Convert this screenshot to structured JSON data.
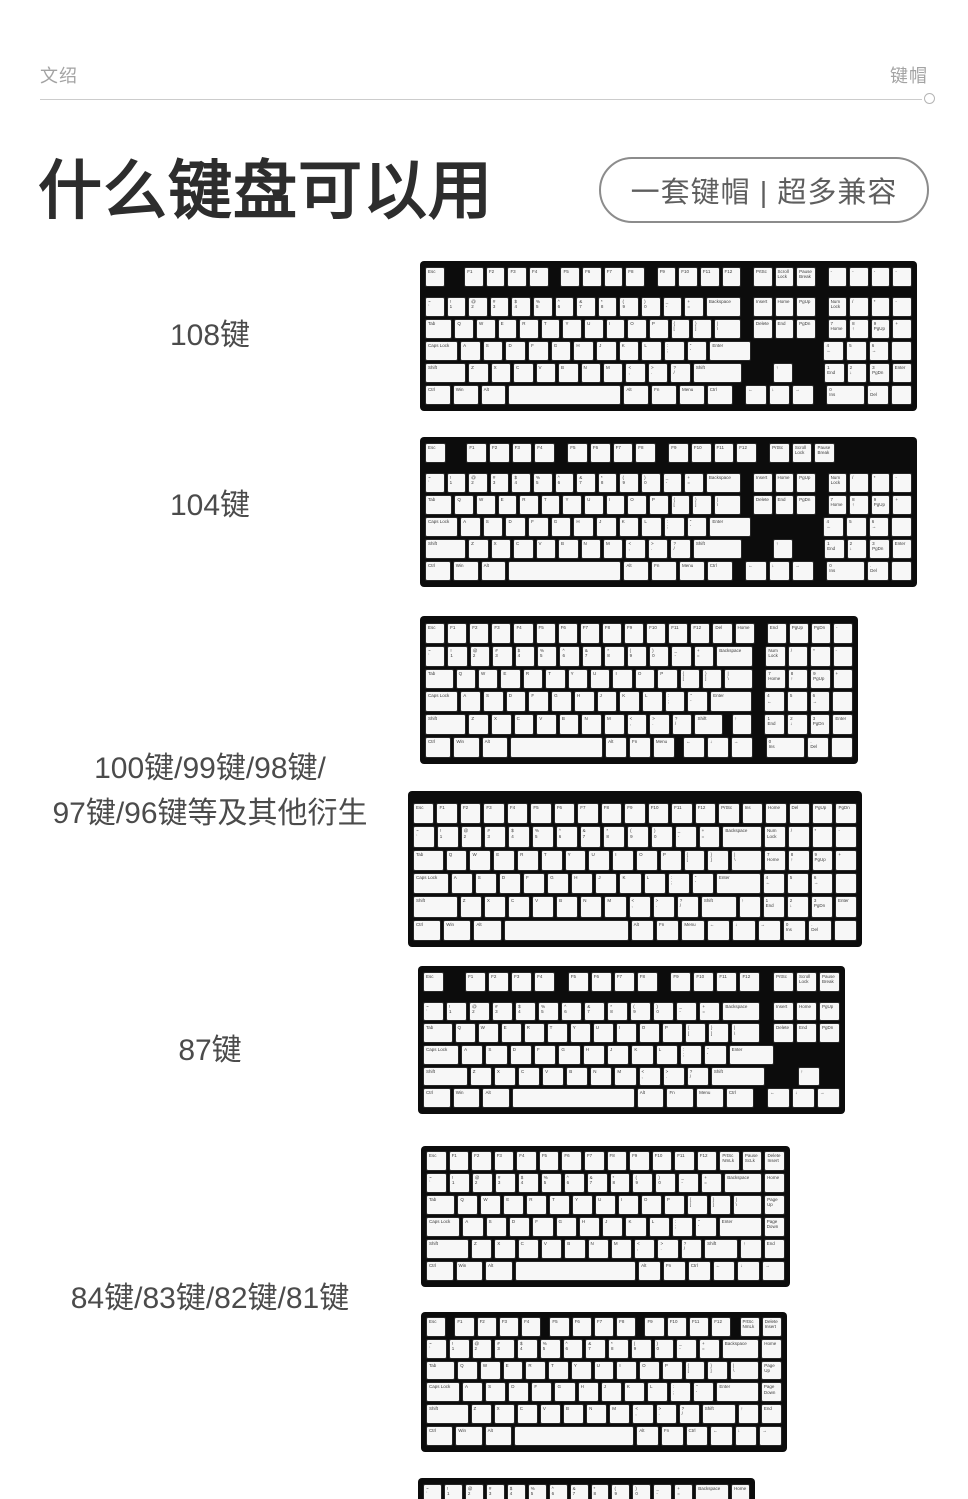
{
  "header": {
    "left": "文绍",
    "right": "键帽"
  },
  "title": {
    "text": "什么键盘可以用"
  },
  "badge": {
    "text": "一套键帽  |  超多兼容"
  },
  "colors": {
    "title": "#2d2d2d",
    "row_label": "#4b4b4b",
    "header_text": "#a3a3a3",
    "badge_border": "#8c8c8c",
    "badge_text": "#5e5e5e",
    "rule": "#cccccc",
    "keyboard_bezel": "#0c0c0c",
    "keycap_bg": "#f7f7f7",
    "keycap_border": "#262626",
    "keycap_text": "#3c3c3c"
  },
  "sections": [
    {
      "label_lines": [
        "108键"
      ],
      "label_top": 313
    },
    {
      "label_lines": [
        "104键"
      ],
      "label_top": 483
    },
    {
      "label_lines": [
        "100键/99键/98键/",
        "97键/96键等及其他衍生"
      ],
      "label_top": 746
    },
    {
      "label_lines": [
        "87键"
      ],
      "label_top": 1028
    },
    {
      "label_lines": [
        "84键/83键/82键/81键"
      ],
      "label_top": 1276
    }
  ],
  "lib": {
    "f_gapped": [
      [
        "Esc",
        1
      ],
      [
        "",
        1,
        "g"
      ],
      [
        "F1",
        1
      ],
      [
        "F2",
        1
      ],
      [
        "F3",
        1
      ],
      [
        "F4",
        1
      ],
      [
        "",
        0.5,
        "g"
      ],
      [
        "F5",
        1
      ],
      [
        "F6",
        1
      ],
      [
        "F7",
        1
      ],
      [
        "F8",
        1
      ],
      [
        "",
        0.5,
        "g"
      ],
      [
        "F9",
        1
      ],
      [
        "F10",
        1
      ],
      [
        "F11",
        1
      ],
      [
        "F12",
        1
      ]
    ],
    "fkeys12": [
      [
        "F1",
        1
      ],
      [
        "F2",
        1
      ],
      [
        "F3",
        1
      ],
      [
        "F4",
        1
      ],
      [
        "F5",
        1
      ],
      [
        "F6",
        1
      ],
      [
        "F7",
        1
      ],
      [
        "F8",
        1
      ],
      [
        "F9",
        1
      ],
      [
        "F10",
        1
      ],
      [
        "F11",
        1
      ],
      [
        "F12",
        1
      ]
    ],
    "prt": [
      [
        "",
        0.5,
        "g"
      ],
      [
        "PrtSc",
        1
      ],
      [
        "Scroll\nLock",
        1
      ],
      [
        "Pause\nBreak",
        1
      ]
    ],
    "extra4": [
      [
        "",
        0.5,
        "g"
      ],
      [
        "-",
        1
      ],
      [
        "-",
        1
      ],
      [
        "-",
        1
      ],
      [
        "-",
        1
      ]
    ],
    "extra4_blank": [
      [
        "",
        4.5,
        "g"
      ]
    ],
    "numrow": [
      [
        "~\n`",
        1
      ],
      [
        "!\n1",
        1
      ],
      [
        "@\n2",
        1
      ],
      [
        "#\n3",
        1
      ],
      [
        "$\n4",
        1
      ],
      [
        "%\n5",
        1
      ],
      [
        "^\n6",
        1
      ],
      [
        "&\n7",
        1
      ],
      [
        "*\n8",
        1
      ],
      [
        "(\n9",
        1
      ],
      [
        ")\n0",
        1
      ],
      [
        "_\n-",
        1
      ],
      [
        "+\n=",
        1
      ],
      [
        "Backspace",
        2
      ]
    ],
    "tabrow": [
      [
        "Tab",
        1.5
      ],
      [
        "Q",
        1
      ],
      [
        "W",
        1
      ],
      [
        "E",
        1
      ],
      [
        "R",
        1
      ],
      [
        "T",
        1
      ],
      [
        "Y",
        1
      ],
      [
        "U",
        1
      ],
      [
        "I",
        1
      ],
      [
        "O",
        1
      ],
      [
        "P",
        1
      ],
      [
        "{\n[",
        1
      ],
      [
        "}\n]",
        1
      ],
      [
        "|\n\\",
        1.5
      ]
    ],
    "capsrow": [
      [
        "Caps Lock",
        1.75
      ],
      [
        "A",
        1
      ],
      [
        "S",
        1
      ],
      [
        "D",
        1
      ],
      [
        "F",
        1
      ],
      [
        "G",
        1
      ],
      [
        "H",
        1
      ],
      [
        "J",
        1
      ],
      [
        "K",
        1
      ],
      [
        "L",
        1
      ],
      [
        ":\n;",
        1
      ],
      [
        "\"\n'",
        1
      ],
      [
        "Enter",
        2.25
      ]
    ],
    "zkeys": [
      [
        "Z",
        1
      ],
      [
        "X",
        1
      ],
      [
        "C",
        1
      ],
      [
        "V",
        1
      ],
      [
        "B",
        1
      ],
      [
        "N",
        1
      ],
      [
        "M",
        1
      ],
      [
        "<\n,",
        1
      ],
      [
        ">\n.",
        1
      ],
      [
        "?\n/",
        1
      ]
    ],
    "shiftrow": [
      [
        "Shift",
        2.25
      ],
      "zkeys",
      [
        "Shift",
        2.75
      ]
    ],
    "bottomrow": [
      [
        "Ctrl",
        1.25
      ],
      [
        "Win",
        1.25
      ],
      [
        "Alt",
        1.25
      ],
      [
        "",
        6.25
      ],
      [
        "Alt",
        1.25
      ],
      [
        "Fn",
        1.25
      ],
      [
        "Menu",
        1.25
      ],
      [
        "Ctrl",
        1.25
      ]
    ],
    "nav1": [
      [
        "",
        0.5,
        "g"
      ],
      [
        "Insert",
        1
      ],
      [
        "Home",
        1
      ],
      [
        "PgUp",
        1
      ]
    ],
    "nav2": [
      [
        "",
        0.5,
        "g"
      ],
      [
        "Delete",
        1
      ],
      [
        "End",
        1
      ],
      [
        "PgDn",
        1
      ]
    ],
    "nav3": [
      [
        "",
        3.5,
        "g"
      ]
    ],
    "nav_up": [
      [
        "",
        0.5,
        "g"
      ],
      [
        "",
        1,
        "g"
      ],
      [
        "↑",
        1
      ],
      [
        "",
        1,
        "g"
      ]
    ],
    "nav_arr": [
      [
        "",
        0.5,
        "g"
      ],
      [
        "←",
        1
      ],
      [
        "↓",
        1
      ],
      [
        "→",
        1
      ]
    ],
    "np1": [
      [
        "",
        0.5,
        "g"
      ],
      [
        "Num\nLock",
        1
      ],
      [
        "/",
        1
      ],
      [
        "*",
        1
      ],
      [
        "-",
        1
      ]
    ],
    "np2": [
      [
        "",
        0.5,
        "g"
      ],
      [
        "7\nHome",
        1
      ],
      [
        "8\n↑",
        1
      ],
      [
        "9\nPgUp",
        1
      ],
      [
        "+",
        1
      ]
    ],
    "np3": [
      [
        "",
        0.5,
        "g"
      ],
      [
        "4\n←",
        1
      ],
      [
        "5",
        1
      ],
      [
        "6\n→",
        1
      ],
      [
        "",
        1
      ]
    ],
    "np4": [
      [
        "",
        0.5,
        "g"
      ],
      [
        "1\nEnd",
        1
      ],
      [
        "2\n↓",
        1
      ],
      [
        "3\nPgDn",
        1
      ],
      [
        "Enter",
        1
      ]
    ],
    "np5": [
      [
        "",
        0.5,
        "g"
      ],
      [
        "0\nIns",
        2
      ],
      [
        ".\nDel",
        1
      ],
      [
        "",
        1
      ]
    ],
    "np1n": [
      [
        "Num\nLock",
        1
      ],
      [
        "/",
        1
      ],
      [
        "*",
        1
      ],
      [
        "-",
        1
      ]
    ],
    "np2n": [
      [
        "7\nHome",
        1
      ],
      [
        "8\n↑",
        1
      ],
      [
        "9\nPgUp",
        1
      ],
      [
        "+",
        1
      ]
    ],
    "np3n": [
      [
        "4\n←",
        1
      ],
      [
        "5",
        1
      ],
      [
        "6\n→",
        1
      ],
      [
        "",
        1
      ]
    ],
    "np4n": [
      [
        "1\nEnd",
        1
      ],
      [
        "2\n↓",
        1
      ],
      [
        "3\nPgDn",
        1
      ],
      [
        "Enter",
        1
      ]
    ],
    "np5n": [
      [
        "0\nIns",
        1
      ],
      [
        ".\nDel",
        1
      ],
      [
        "",
        1
      ]
    ],
    "home1": [
      [
        "Home",
        1
      ]
    ],
    "pgup1": [
      [
        "Page\nUp",
        1
      ]
    ],
    "pgdn1": [
      [
        "Page\nDown",
        1
      ]
    ],
    "shift84": [
      [
        "Shift",
        2.25
      ],
      "zkeys",
      [
        "Shift",
        1.75
      ],
      [
        "↑",
        1
      ],
      [
        "End",
        1
      ]
    ],
    "bottom84": [
      [
        "Ctrl",
        1.25
      ],
      [
        "Win",
        1.25
      ],
      [
        "Alt",
        1.25
      ],
      [
        "",
        6.25
      ],
      [
        "Alt",
        1
      ],
      [
        "Fn",
        1
      ],
      [
        "Ctrl",
        1
      ],
      [
        "←",
        1
      ],
      [
        "↓",
        1
      ],
      [
        "→",
        1
      ]
    ]
  },
  "keyboards": [
    {
      "id": "kb108",
      "x": 420,
      "y": 261,
      "w": 497,
      "h": 150,
      "pt": 6,
      "fgap": 8,
      "rows": [
        [
          "f_gapped",
          "prt",
          "extra4"
        ],
        [
          "numrow",
          "nav1",
          "np1"
        ],
        [
          "tabrow",
          "nav2",
          "np2"
        ],
        [
          "capsrow",
          "nav3",
          "np3"
        ],
        [
          "shiftrow",
          "nav_up",
          "np4"
        ],
        [
          "bottomrow",
          "nav_arr",
          "np5"
        ]
      ]
    },
    {
      "id": "kb104",
      "x": 420,
      "y": 437,
      "w": 497,
      "h": 150,
      "pt": 6,
      "fgap": 8,
      "rows": [
        [
          "f_gapped",
          "prt",
          "extra4_blank"
        ],
        [
          "numrow",
          "nav1",
          "np1"
        ],
        [
          "tabrow",
          "nav2",
          "np2"
        ],
        [
          "capsrow",
          "nav3",
          "np3"
        ],
        [
          "shiftrow",
          "nav_up",
          "np4"
        ],
        [
          "bottomrow",
          "nav_arr",
          "np5"
        ]
      ]
    },
    {
      "id": "kb96a",
      "x": 420,
      "y": 616,
      "w": 438,
      "h": 148,
      "pt": 7,
      "fgap": 0,
      "rows": [
        [
          [
            "Esc",
            1
          ],
          "fkeys12",
          [
            "Del",
            1
          ],
          [
            "Home",
            1
          ],
          [
            "",
            0.5,
            "g"
          ],
          [
            "End",
            1
          ],
          [
            "PgUp",
            1
          ],
          [
            "PgDn",
            1
          ],
          [
            "-",
            1
          ]
        ],
        [
          "numrow",
          "np1"
        ],
        [
          "tabrow",
          "np2"
        ],
        [
          "capsrow",
          "np3"
        ],
        [
          [
            "Shift",
            2.25
          ],
          "zkeys",
          [
            "Shift",
            1.5
          ],
          [
            "",
            0.25,
            "g"
          ],
          [
            "↑",
            1
          ],
          "np4"
        ],
        [
          [
            "Ctrl",
            1.25
          ],
          [
            "Win",
            1.25
          ],
          [
            "Alt",
            1.25
          ],
          [
            "",
            5
          ],
          [
            "Alt",
            1
          ],
          [
            "Fn",
            1
          ],
          [
            "Menu",
            1
          ],
          [
            "",
            0.25,
            "g"
          ],
          [
            "←",
            1
          ],
          [
            "↓",
            1
          ],
          [
            "→",
            1
          ],
          "np5"
        ]
      ]
    },
    {
      "id": "kb96b",
      "x": 408,
      "y": 791,
      "w": 454,
      "h": 156,
      "pt": 12,
      "fgap": 0,
      "rows": [
        [
          [
            "Esc",
            1
          ],
          "fkeys12",
          [
            "PrtSc",
            1
          ],
          [
            "Ins",
            1
          ],
          [
            "Home",
            1
          ],
          [
            "Del",
            1
          ],
          [
            "PgUp",
            1
          ],
          [
            "PgDn",
            1
          ]
        ],
        [
          "numrow",
          "np1n"
        ],
        [
          "tabrow",
          "np2n"
        ],
        [
          "capsrow",
          "np3n"
        ],
        [
          [
            "Shift",
            2.25
          ],
          "zkeys",
          [
            "Shift",
            1.75
          ],
          [
            "↑",
            1
          ],
          "np4n"
        ],
        [
          [
            "Ctrl",
            1.25
          ],
          [
            "Win",
            1.25
          ],
          [
            "Alt",
            1.25
          ],
          [
            "",
            6.25
          ],
          [
            "Alt",
            1
          ],
          [
            "Fn",
            1
          ],
          [
            "Menu",
            1
          ],
          [
            "←",
            1
          ],
          [
            "↓",
            1
          ],
          [
            "→",
            1
          ],
          "np5n"
        ]
      ]
    },
    {
      "id": "kb87",
      "x": 418,
      "y": 966,
      "w": 427,
      "h": 148,
      "pt": 6,
      "fgap": 8,
      "rows": [
        [
          "f_gapped",
          "prt"
        ],
        [
          "numrow",
          "nav1"
        ],
        [
          "tabrow",
          "nav2"
        ],
        [
          "capsrow",
          "nav3"
        ],
        [
          "shiftrow",
          "nav_up"
        ],
        [
          "bottomrow",
          "nav_arr"
        ]
      ]
    },
    {
      "id": "kb84a",
      "x": 421,
      "y": 1146,
      "w": 369,
      "h": 141,
      "pt": 5,
      "fgap": 0,
      "rows": [
        [
          [
            "Esc",
            1
          ],
          "fkeys12",
          [
            "PrtSc\nNmLk",
            1
          ],
          [
            "Pause\nScLk",
            1
          ],
          [
            "Delete\nInsert",
            1
          ]
        ],
        [
          "numrow",
          "home1"
        ],
        [
          "tabrow",
          "pgup1"
        ],
        [
          "capsrow",
          "pgdn1"
        ],
        [
          "shift84"
        ],
        [
          "bottom84"
        ]
      ]
    },
    {
      "id": "kb84b",
      "x": 421,
      "y": 1312,
      "w": 366,
      "h": 140,
      "pt": 5,
      "fgap": 0,
      "rows": [
        [
          [
            "Esc",
            1
          ],
          [
            "",
            0.25,
            "g"
          ],
          [
            "F1",
            1
          ],
          [
            "F2",
            1
          ],
          [
            "F3",
            1
          ],
          [
            "F4",
            1
          ],
          [
            "",
            0.25,
            "g"
          ],
          [
            "F5",
            1
          ],
          [
            "F6",
            1
          ],
          [
            "F7",
            1
          ],
          [
            "F8",
            1
          ],
          [
            "",
            0.25,
            "g"
          ],
          [
            "F9",
            1
          ],
          [
            "F10",
            1
          ],
          [
            "F11",
            1
          ],
          [
            "F12",
            1
          ],
          [
            "",
            0.25,
            "g"
          ],
          [
            "PrtSc\nNmLk",
            1
          ],
          [
            "Delete\nInsert",
            1
          ]
        ],
        [
          "numrow",
          "home1"
        ],
        [
          "tabrow",
          "pgup1"
        ],
        [
          "capsrow",
          "pgdn1"
        ],
        [
          "shift84"
        ],
        [
          "bottom84"
        ]
      ]
    },
    {
      "id": "kb65",
      "x": 418,
      "y": 1478,
      "w": 337,
      "h": 42,
      "pt": 6,
      "fgap": 0,
      "rows": [
        [
          "numrow",
          "home1"
        ]
      ]
    }
  ]
}
